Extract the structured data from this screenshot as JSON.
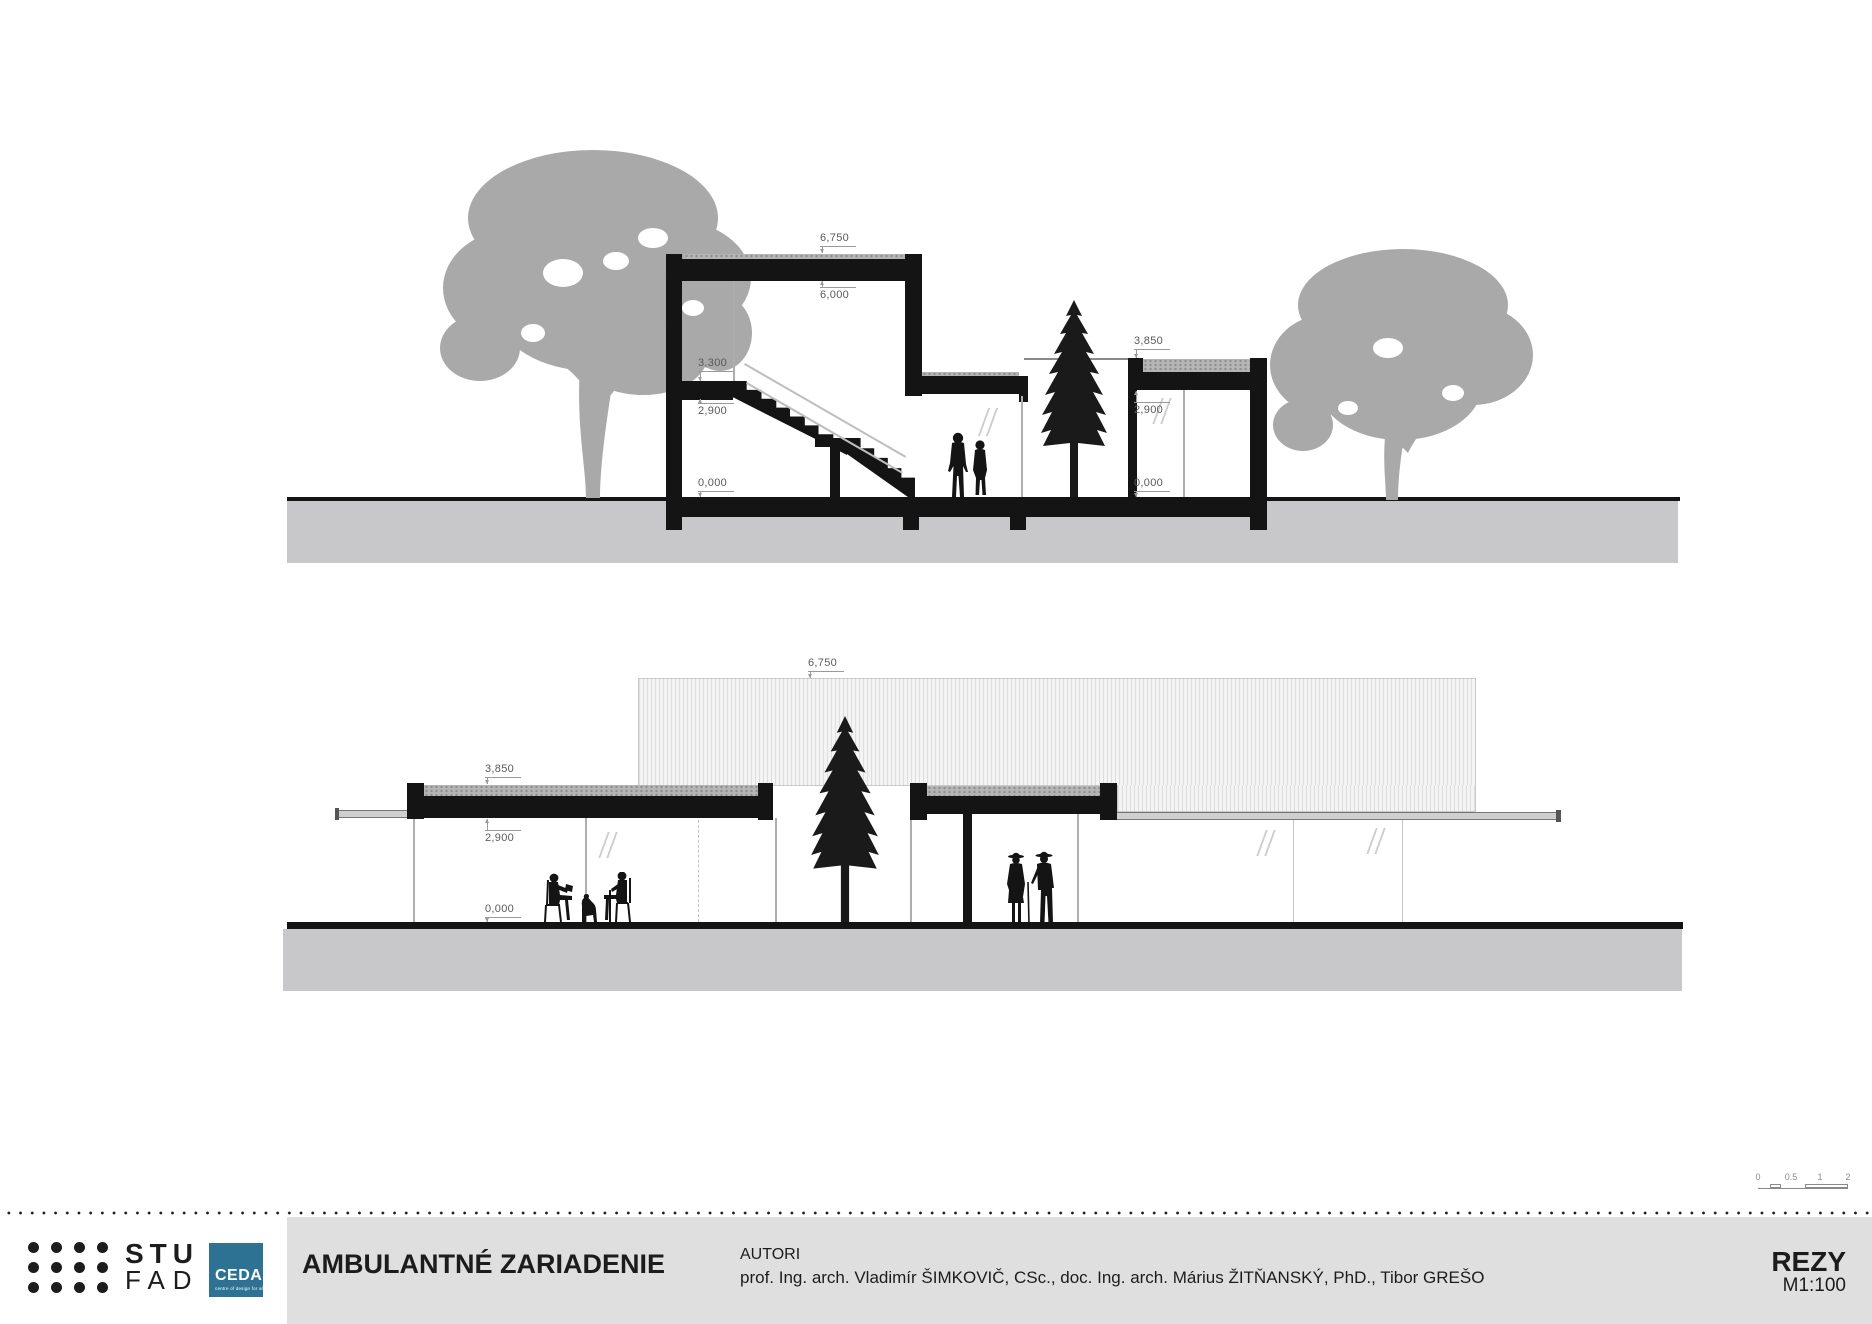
{
  "sections": {
    "top": {
      "dims": [
        "6,750",
        "6,000",
        "3,300",
        "2,900",
        "0,000",
        "3,850",
        "2,900",
        "0,000"
      ]
    },
    "bottom": {
      "dims": [
        "6,750",
        "3,850",
        "2,900",
        "0,000"
      ]
    }
  },
  "scalebar": {
    "labels": [
      "0",
      "0.5",
      "1",
      "2"
    ]
  },
  "footer": {
    "logo": {
      "stu": "STU",
      "fad": "FAD",
      "ceda": "CEDA",
      "ceda_sub": "centre of design for all"
    },
    "title": "AMBULANTNÉ ZARIADENIE",
    "authors_label": "AUTORI",
    "authors": "prof. Ing. arch. Vladimír ŠIMKOVIČ, CSc., doc. Ing. arch. Márius ŽITŇANSKÝ, PhD., Tibor GREŠO",
    "sheet": "REZY",
    "scale": "M1:100"
  },
  "colors": {
    "black": "#141414",
    "ground_gray": "#c8c8ca",
    "tree_gray": "#a9a9a9",
    "footer_gray": "#dfdfdf",
    "ceda_blue": "#2d7292"
  }
}
